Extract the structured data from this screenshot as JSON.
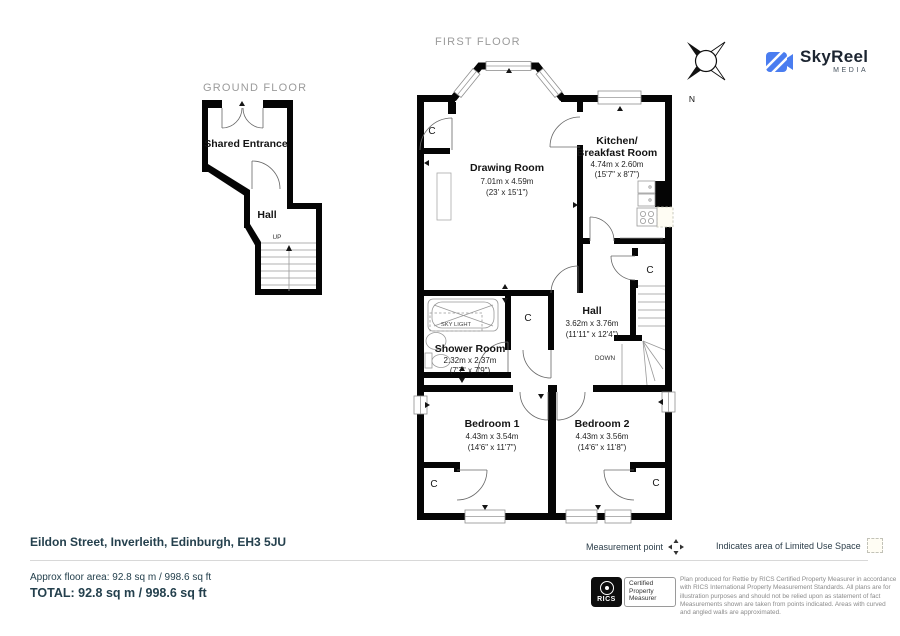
{
  "branding": {
    "logo_text": "SkyReel",
    "logo_sub": "MEDIA",
    "brand_blue": "#4a7df0"
  },
  "compass": {
    "north_label": "N"
  },
  "floors": {
    "first": {
      "title": "FIRST FLOOR",
      "rooms": {
        "drawing_room": {
          "name": "Drawing Room",
          "metric": "7.01m x 4.59m",
          "imperial": "(23' x 15'1\")"
        },
        "kitchen": {
          "name_line1": "Kitchen/",
          "name_line2": "Breakfast Room",
          "metric": "4.74m x 2.60m",
          "imperial": "(15'7\" x 8'7\")"
        },
        "hall": {
          "name": "Hall",
          "metric": "3.62m x 3.76m",
          "imperial": "(11'11\" x 12'4\")"
        },
        "shower_room": {
          "name": "Shower Room",
          "metric": "2.32m x 2.37m",
          "imperial": "(7'7\" x 7'9\")"
        },
        "bedroom1": {
          "name": "Bedroom 1",
          "metric": "4.43m x 3.54m",
          "imperial": "(14'6\" x 11'7\")"
        },
        "bedroom2": {
          "name": "Bedroom 2",
          "metric": "4.43m x 3.56m",
          "imperial": "(14'6\" x 11'8\")"
        }
      },
      "annotations": {
        "cupboard": "C",
        "down": "DOWN",
        "sky_light": "SKY LIGHT"
      }
    },
    "ground": {
      "title": "GROUND FLOOR",
      "rooms": {
        "shared_entrance": {
          "name": "Shared Entrance"
        },
        "hall": {
          "name": "Hall"
        }
      },
      "annotations": {
        "up": "UP"
      }
    }
  },
  "footer": {
    "address": "Eildon Street, Inverleith, Edinburgh, EH3 5JU",
    "approx_area": "Approx floor area: 92.8 sq m / 998.6 sq ft",
    "total_area": "TOTAL: 92.8 sq m / 998.6 sq ft",
    "legend": {
      "measurement_point": "Measurement point",
      "limited_use": "Indicates area of  Limited Use Space"
    },
    "rics": {
      "acronym": "RICS",
      "certified_line1": "Certified",
      "certified_line2": "Property",
      "certified_line3": "Measurer"
    },
    "disclaimer": "Plan produced for Rettie by RICS Certified Property Measurer in accordance with RICS International Property  Measurement Standards.  All plans are for illustration purposes and should not be relied upon as statement of fact Measurements shown are taken from points indicated. Areas with curved and angled walls are approximated."
  }
}
